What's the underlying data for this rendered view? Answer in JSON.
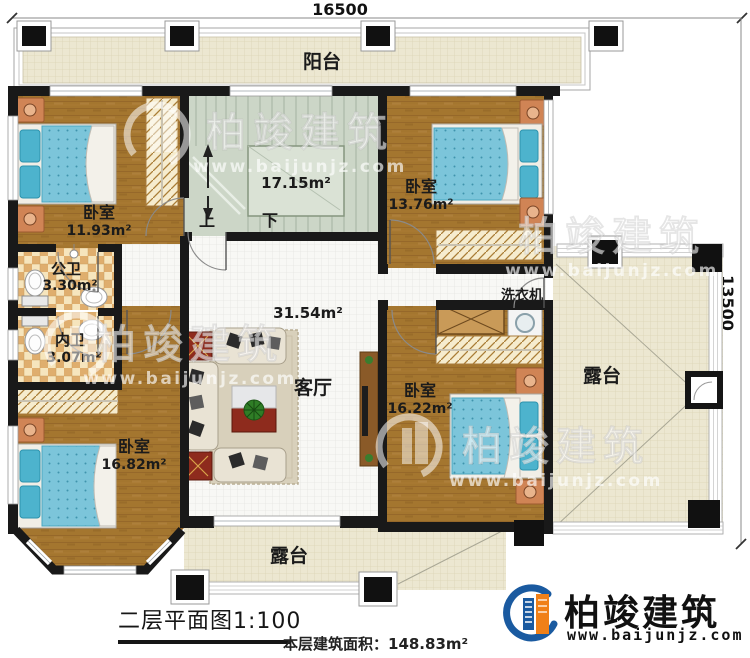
{
  "dimensions": {
    "top": "16500",
    "right": "13500"
  },
  "rooms": {
    "balcony": {
      "label": "阳台"
    },
    "bedroom_top_left": {
      "label": "卧室",
      "area": "11.93m²"
    },
    "stairwell": {
      "area": "17.15m²",
      "up_label": "上",
      "down_label": "下"
    },
    "bedroom_top_right": {
      "label": "卧室",
      "area": "13.76m²"
    },
    "public_bathroom": {
      "label": "公卫",
      "area": "3.30m²"
    },
    "private_bathroom": {
      "label": "内卫",
      "area": "3.07m²"
    },
    "bedroom_bottom_left": {
      "label": "卧室",
      "area": "16.82m²"
    },
    "living_room": {
      "label": "客厅",
      "area": "31.54m²"
    },
    "bedroom_bottom_right": {
      "label": "卧室",
      "area": "16.22m²"
    },
    "laundry": {
      "label": "洗衣机"
    },
    "terrace_right": {
      "label": "露台"
    },
    "terrace_bottom": {
      "label": "露台"
    }
  },
  "footer": {
    "plan_title": "二层平面图1:100",
    "floor_area_label": "本层建筑面积：148.83m²"
  },
  "brand": {
    "name": "柏竣建筑",
    "website": "www.baijunjz.com"
  },
  "watermark": {
    "name": "柏竣建筑",
    "website": "www.baijunjz.com"
  },
  "colors": {
    "wall": "#191919",
    "wood_floor": "#a4762f",
    "terrace_floor": "#ece7d1",
    "stair_floor": "#ccd6c7",
    "tile": "#dfae6e",
    "bed": "#7cc5da",
    "brand_blue": "#1a5aa0",
    "brand_orange": "#f08018"
  }
}
